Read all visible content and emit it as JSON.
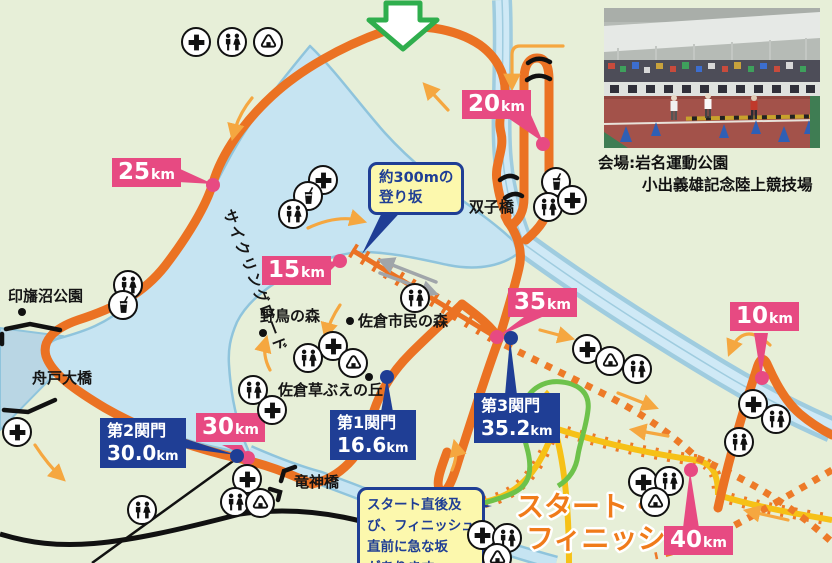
{
  "map": {
    "badges": {
      "km10": {
        "value": "10",
        "unit": "km"
      },
      "km15": {
        "value": "15",
        "unit": "km"
      },
      "km20": {
        "value": "20",
        "unit": "km"
      },
      "km25": {
        "value": "25",
        "unit": "km"
      },
      "km30": {
        "value": "30",
        "unit": "km"
      },
      "km35": {
        "value": "35",
        "unit": "km"
      },
      "km40": {
        "value": "40",
        "unit": "km"
      }
    },
    "checkpoints": {
      "cp1": {
        "title": "第1関門",
        "value": "16.6",
        "unit": "km"
      },
      "cp2": {
        "title": "第2関門",
        "value": "30.0",
        "unit": "km"
      },
      "cp3": {
        "title": "第3関門",
        "value": "35.2",
        "unit": "km"
      }
    },
    "places": {
      "inbanuma_park": "印旛沼公園",
      "funado_bridge": "舟戸大橋",
      "ryujin_bridge": "竜神橋",
      "futago_bridge": "双子橋",
      "yacho_forest": "野鳥の森",
      "sakura_shimin_forest": "佐倉市民の森",
      "kusabue_hill": "佐倉草ぶえの丘",
      "cycling_road": "サイクリングロード"
    },
    "callouts": {
      "slope300m": {
        "line1": "約300mの",
        "line2": "登り坂"
      },
      "steep": {
        "lines": [
          "スタート直後及",
          "び、フィニッシュ",
          "直前に急な坂",
          "があります。"
        ]
      }
    },
    "start_finish": {
      "line1": "スタート・",
      "line2": "フィニッシュ"
    },
    "venue": {
      "caption_line1": "会場:岩名運動公園",
      "caption_line2": "小出義雄記念陸上競技場"
    },
    "colors": {
      "background": "#e7efd8",
      "lake": "#c6e4f2",
      "lake_shore": "#8fc4dc",
      "course_orange": "#eb7223",
      "route_yellow": "#f6c117",
      "route_green": "#6dc24b",
      "badge_pink": "#e74a82",
      "checkpoint_blue": "#1f3e95",
      "callout_yellow": "#fcf8ad",
      "arrow_orange": "#f5a740",
      "arrow_gray": "#a0a5aa",
      "direction_arrow_green": "#2fae4d"
    },
    "icons": [
      {
        "t": "cross",
        "x": 196,
        "y": 42
      },
      {
        "t": "toilet",
        "x": 232,
        "y": 42
      },
      {
        "t": "onigiri",
        "x": 268,
        "y": 42
      },
      {
        "t": "cross",
        "x": 323,
        "y": 180
      },
      {
        "t": "drink",
        "x": 308,
        "y": 196
      },
      {
        "t": "toilet",
        "x": 293,
        "y": 214
      },
      {
        "t": "toilet",
        "x": 128,
        "y": 285
      },
      {
        "t": "drink",
        "x": 123,
        "y": 305
      },
      {
        "t": "drink",
        "x": 556,
        "y": 182
      },
      {
        "t": "toilet",
        "x": 548,
        "y": 207
      },
      {
        "t": "cross",
        "x": 572,
        "y": 200
      },
      {
        "t": "cross",
        "x": 333,
        "y": 346
      },
      {
        "t": "toilet",
        "x": 308,
        "y": 358
      },
      {
        "t": "onigiri",
        "x": 353,
        "y": 363
      },
      {
        "t": "toilet",
        "x": 415,
        "y": 298
      },
      {
        "t": "toilet",
        "x": 253,
        "y": 390
      },
      {
        "t": "cross",
        "x": 272,
        "y": 410
      },
      {
        "t": "cross",
        "x": 17,
        "y": 432
      },
      {
        "t": "toilet",
        "x": 142,
        "y": 510
      },
      {
        "t": "cross",
        "x": 247,
        "y": 479
      },
      {
        "t": "toilet",
        "x": 235,
        "y": 502
      },
      {
        "t": "onigiri",
        "x": 260,
        "y": 503
      },
      {
        "t": "cross",
        "x": 587,
        "y": 349
      },
      {
        "t": "onigiri",
        "x": 610,
        "y": 361
      },
      {
        "t": "toilet",
        "x": 637,
        "y": 369
      },
      {
        "t": "cross",
        "x": 753,
        "y": 404
      },
      {
        "t": "toilet",
        "x": 776,
        "y": 419
      },
      {
        "t": "toilet",
        "x": 739,
        "y": 442
      },
      {
        "t": "cross",
        "x": 643,
        "y": 482
      },
      {
        "t": "toilet",
        "x": 669,
        "y": 481
      },
      {
        "t": "onigiri",
        "x": 655,
        "y": 502
      },
      {
        "t": "cross",
        "x": 482,
        "y": 535
      },
      {
        "t": "toilet",
        "x": 507,
        "y": 538
      },
      {
        "t": "onigiri",
        "x": 497,
        "y": 558
      }
    ]
  }
}
